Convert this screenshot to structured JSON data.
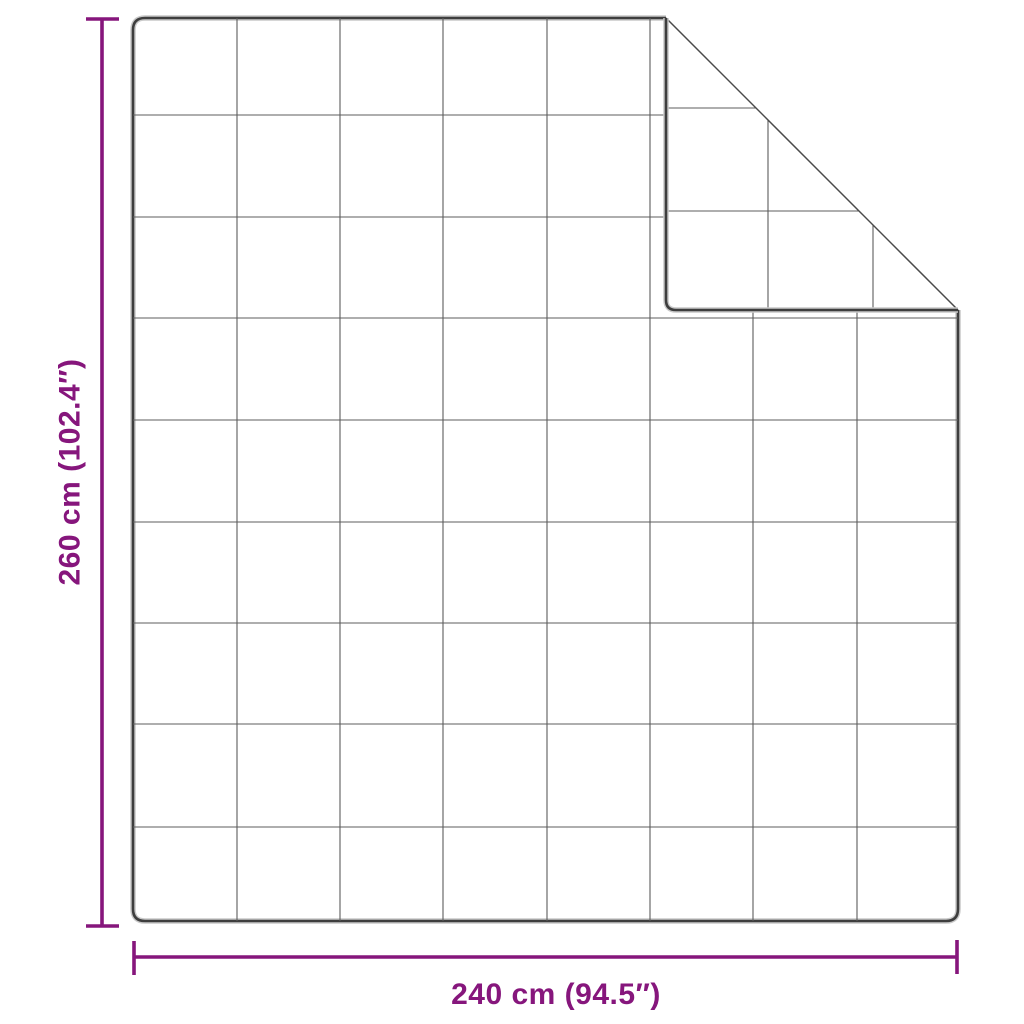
{
  "diagram": {
    "type": "product-dimension-diagram",
    "vertical_label": "260 cm (102.4″)",
    "horizontal_label": "240 cm (94.5″)",
    "grid": {
      "columns": 8,
      "rows": 9
    }
  },
  "colors": {
    "accent": "#86167C",
    "outline": "#3E3E3E",
    "outline-halo": "#C9C9C9",
    "grid-line": "#5C5C5C",
    "crease": "#4A4A4A",
    "background": "#FFFFFF"
  }
}
